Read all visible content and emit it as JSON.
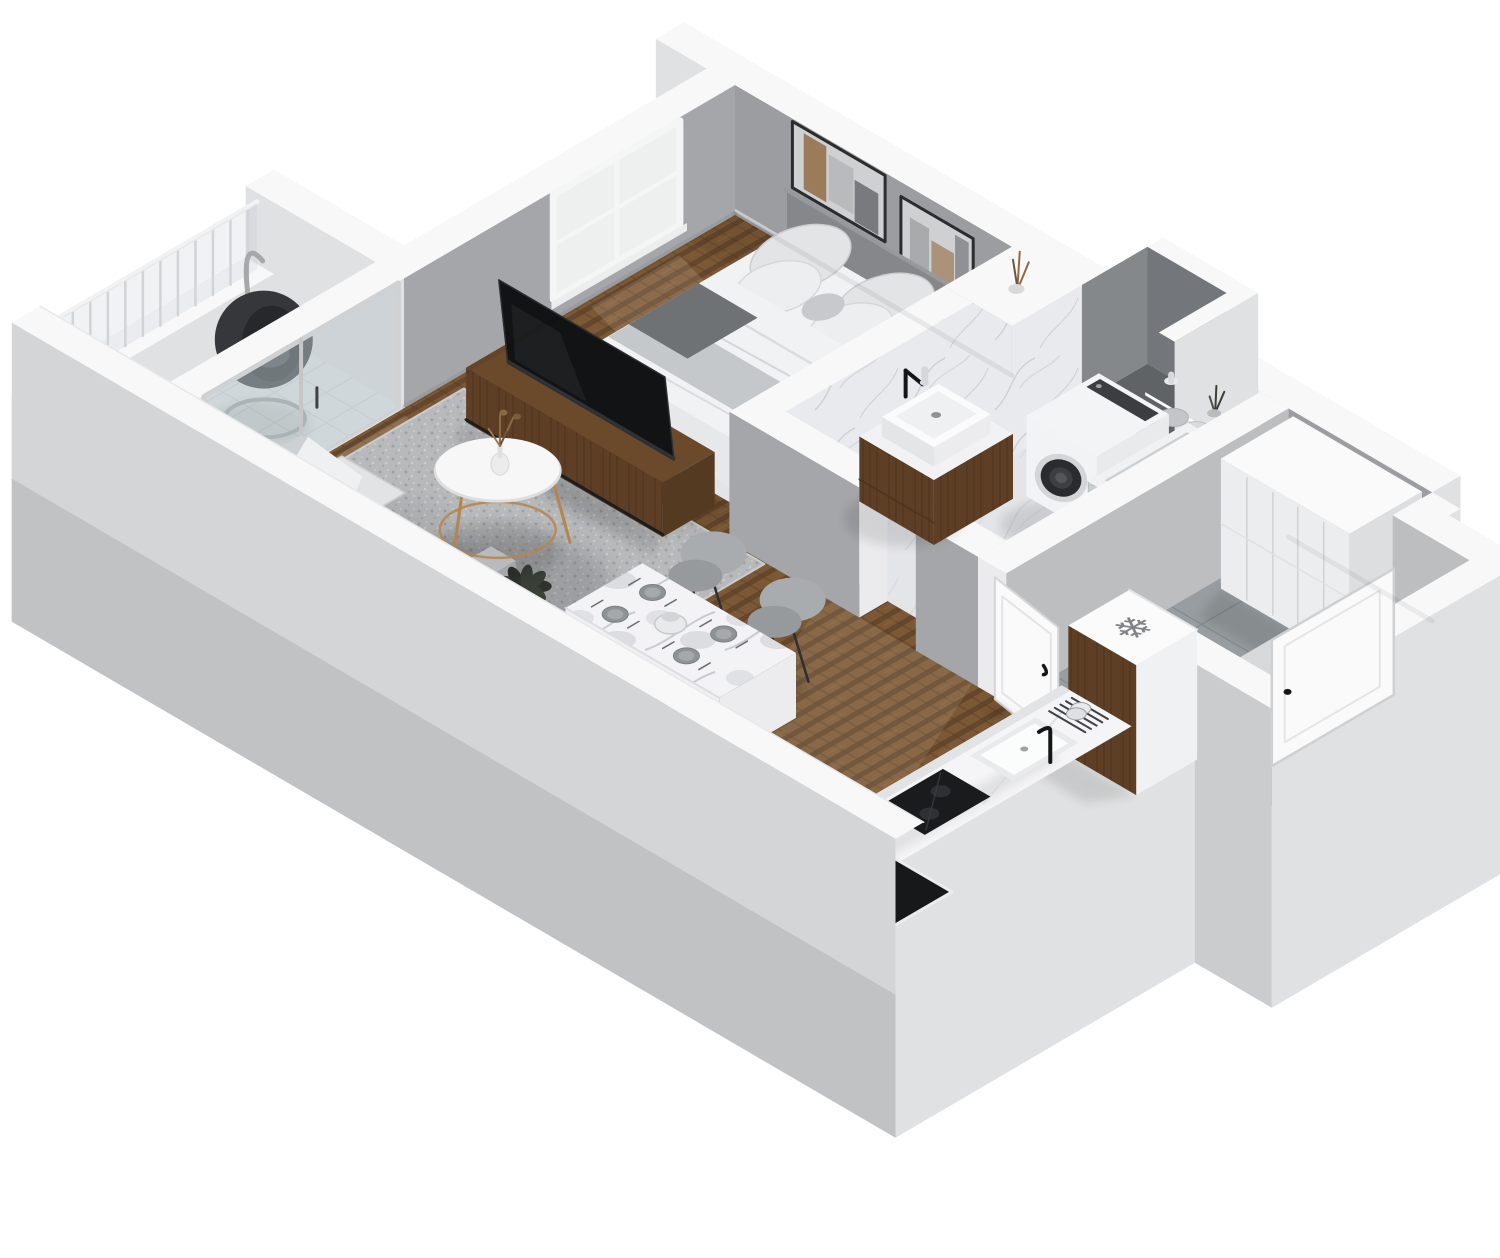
{
  "scene": {
    "title": "3D isometric cutaway floor plan render of a studio apartment",
    "view": "isometric dollhouse cutaway, no visible text labels",
    "background_color": "#ffffff"
  },
  "icons": {
    "snowflake": {
      "name": "snowflake-icon",
      "glyph": "❄",
      "meaning": "refrigerator-freezer marker on fridge top"
    }
  },
  "palette": {
    "band": "#f8f8f9",
    "band2": "#ebebed",
    "extWall": "#e0e1e2",
    "extWallDark": "#cbcccd",
    "slab": "#d4d5d6",
    "slabDark": "#c1c2c3",
    "intWall": "#9b9da0",
    "intWall2": "#a4a6a9",
    "intWallLight": "#bcbec0",
    "marble": "#e9eaed",
    "vein": "#c6c8cd",
    "marbleFloor": "#dfe0e3",
    "tile": "#979da0",
    "grout": "#858b8e",
    "balTile": "#e7e9e8",
    "balGrout": "#d2d6d5",
    "glass": "#b9c6cb",
    "wood": "#5e3f25",
    "woodDark": "#4c331d",
    "woodTop": "#6b4a2c",
    "floorWoodA": "#7b5836",
    "floorWoodB": "#63452a",
    "floorWoodC": "#8a6540",
    "black": "#151618",
    "white": "#fafafa",
    "bedWhite": "#f1f2f4",
    "sheetShade": "#dcdee0",
    "pillow": "#e2e4e6",
    "blanket": "#c5c8cb",
    "headboard": "#85878a",
    "throwDark": "#6f7275",
    "sofa": "#ced1d4",
    "sofaShade": "#b8bbbe",
    "cushion": "#e1e3e5",
    "rug": "#b8b9bb",
    "rugDark": "#a0a1a4",
    "rugLight": "#cbccce",
    "chair": "#a8acaf",
    "chairDark": "#8d9194",
    "chairSeat": "#969a9d",
    "gold": "#b5854e",
    "washer": "#f3f4f5",
    "drum": "#2a2b2e",
    "mosaic": "#c9ced0",
    "mosaicGrout": "#aeb4b6",
    "plant": "#3a3f38",
    "plantDark": "#2e332d",
    "dried": "#8a6a48",
    "art": "#cfd0d2",
    "artWood": "#96714c",
    "artDark": "#5b5d60",
    "counterTop": "#f5f5f7",
    "tableTop": "#f3f3f5",
    "doorWhite": "#fafafa",
    "steel": "#3f4144"
  },
  "rooms": [
    {
      "id": "living-area",
      "name": "living area",
      "furniture": [
        "sofa with white throw and cushions",
        "gray speckled area rug",
        "round coffee table with gold legs",
        "vase with dried flowers",
        "potted plant",
        "wooden media console",
        "flat tv",
        "small stool"
      ]
    },
    {
      "id": "sleeping-area",
      "name": "sleeping area",
      "furniture": [
        "double bed with white bedding",
        "gray upholstered headboard",
        "four pillows",
        "gray blanket",
        "dark throw",
        "two framed artworks",
        "window"
      ]
    },
    {
      "id": "bathroom",
      "name": "bathroom",
      "furniture": [
        "wooden vanity with sink and black faucet",
        "washing machine",
        "mosaic tiled shower-tub",
        "wall shelves with towels, candle and plant",
        "marble wall cladding",
        "open door"
      ]
    },
    {
      "id": "hallway",
      "name": "hallway",
      "furniture": [
        "full-height white wardrobe",
        "gray ceramic tile floor",
        "entrance door with handle",
        "open duct shaft"
      ]
    },
    {
      "id": "kitchen",
      "name": "kitchenette",
      "furniture": [
        "fridge with snowflake symbol",
        "marble counter",
        "sink with black faucet",
        "dish drying rack",
        "black cooktop",
        "black floor mat"
      ]
    },
    {
      "id": "balcony",
      "name": "balcony",
      "furniture": [
        "hanging egg chair",
        "railing with vertical bars",
        "white tile floor",
        "sliding glass door"
      ]
    }
  ]
}
